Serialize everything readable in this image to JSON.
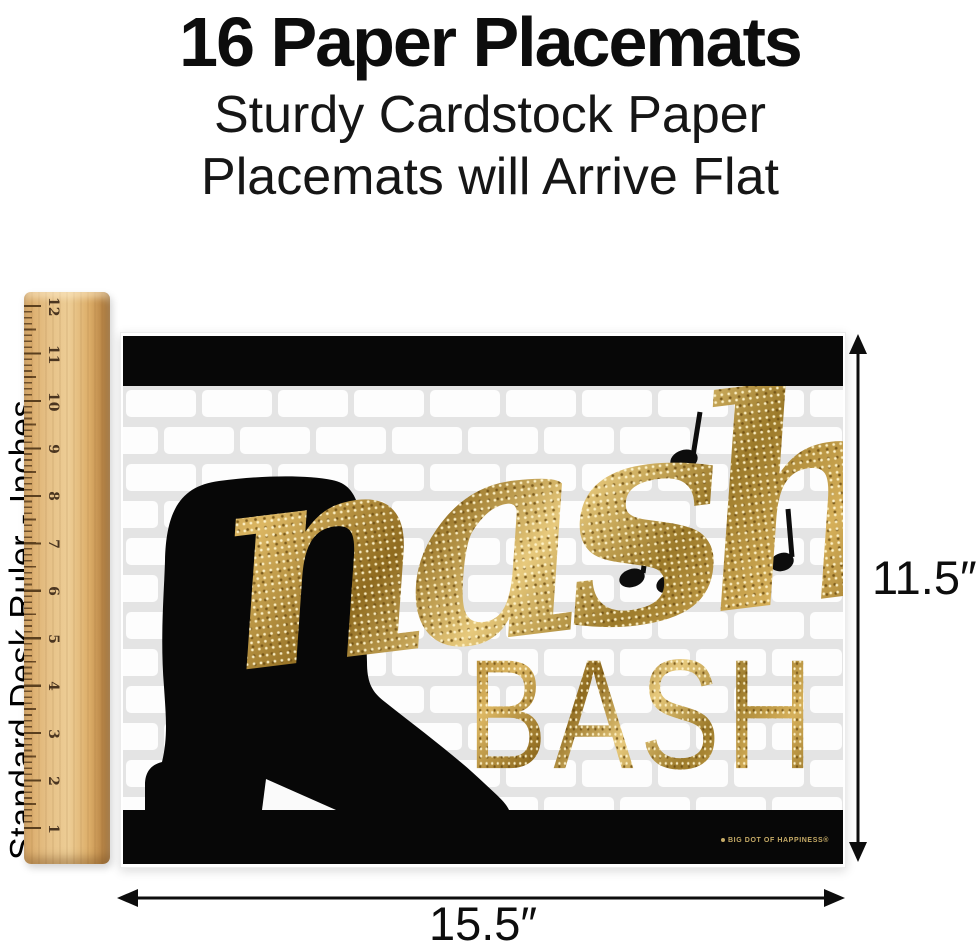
{
  "header": {
    "title": "16 Paper Placemats",
    "subtitle_line1": "Sturdy Cardstock Paper",
    "subtitle_line2": "Placemats will Arrive Flat"
  },
  "ruler": {
    "label": "Standard Desk Ruler - Inches",
    "unit_numbers": [
      "12",
      "11",
      "10",
      "9",
      "8",
      "7",
      "6",
      "5",
      "4",
      "3",
      "2",
      "1"
    ]
  },
  "placemat": {
    "script_word": "nash",
    "caps_word": "BASH",
    "brand_label": "BIG DOT OF HAPPINESS®",
    "icons": {
      "boot": "cowboy-boot-silhouette",
      "notes": "black-eighth-music-notes"
    }
  },
  "dimensions": {
    "height_label": "11.5″",
    "width_label": "15.5″"
  },
  "colors": {
    "gold": "#c49b3e",
    "gold_light": "#ecd592",
    "gold_dark": "#8a671d",
    "black": "#070707",
    "brick_mortar": "#e4e4e4",
    "wood_light": "#eac88e",
    "wood_dark": "#a87a40"
  }
}
